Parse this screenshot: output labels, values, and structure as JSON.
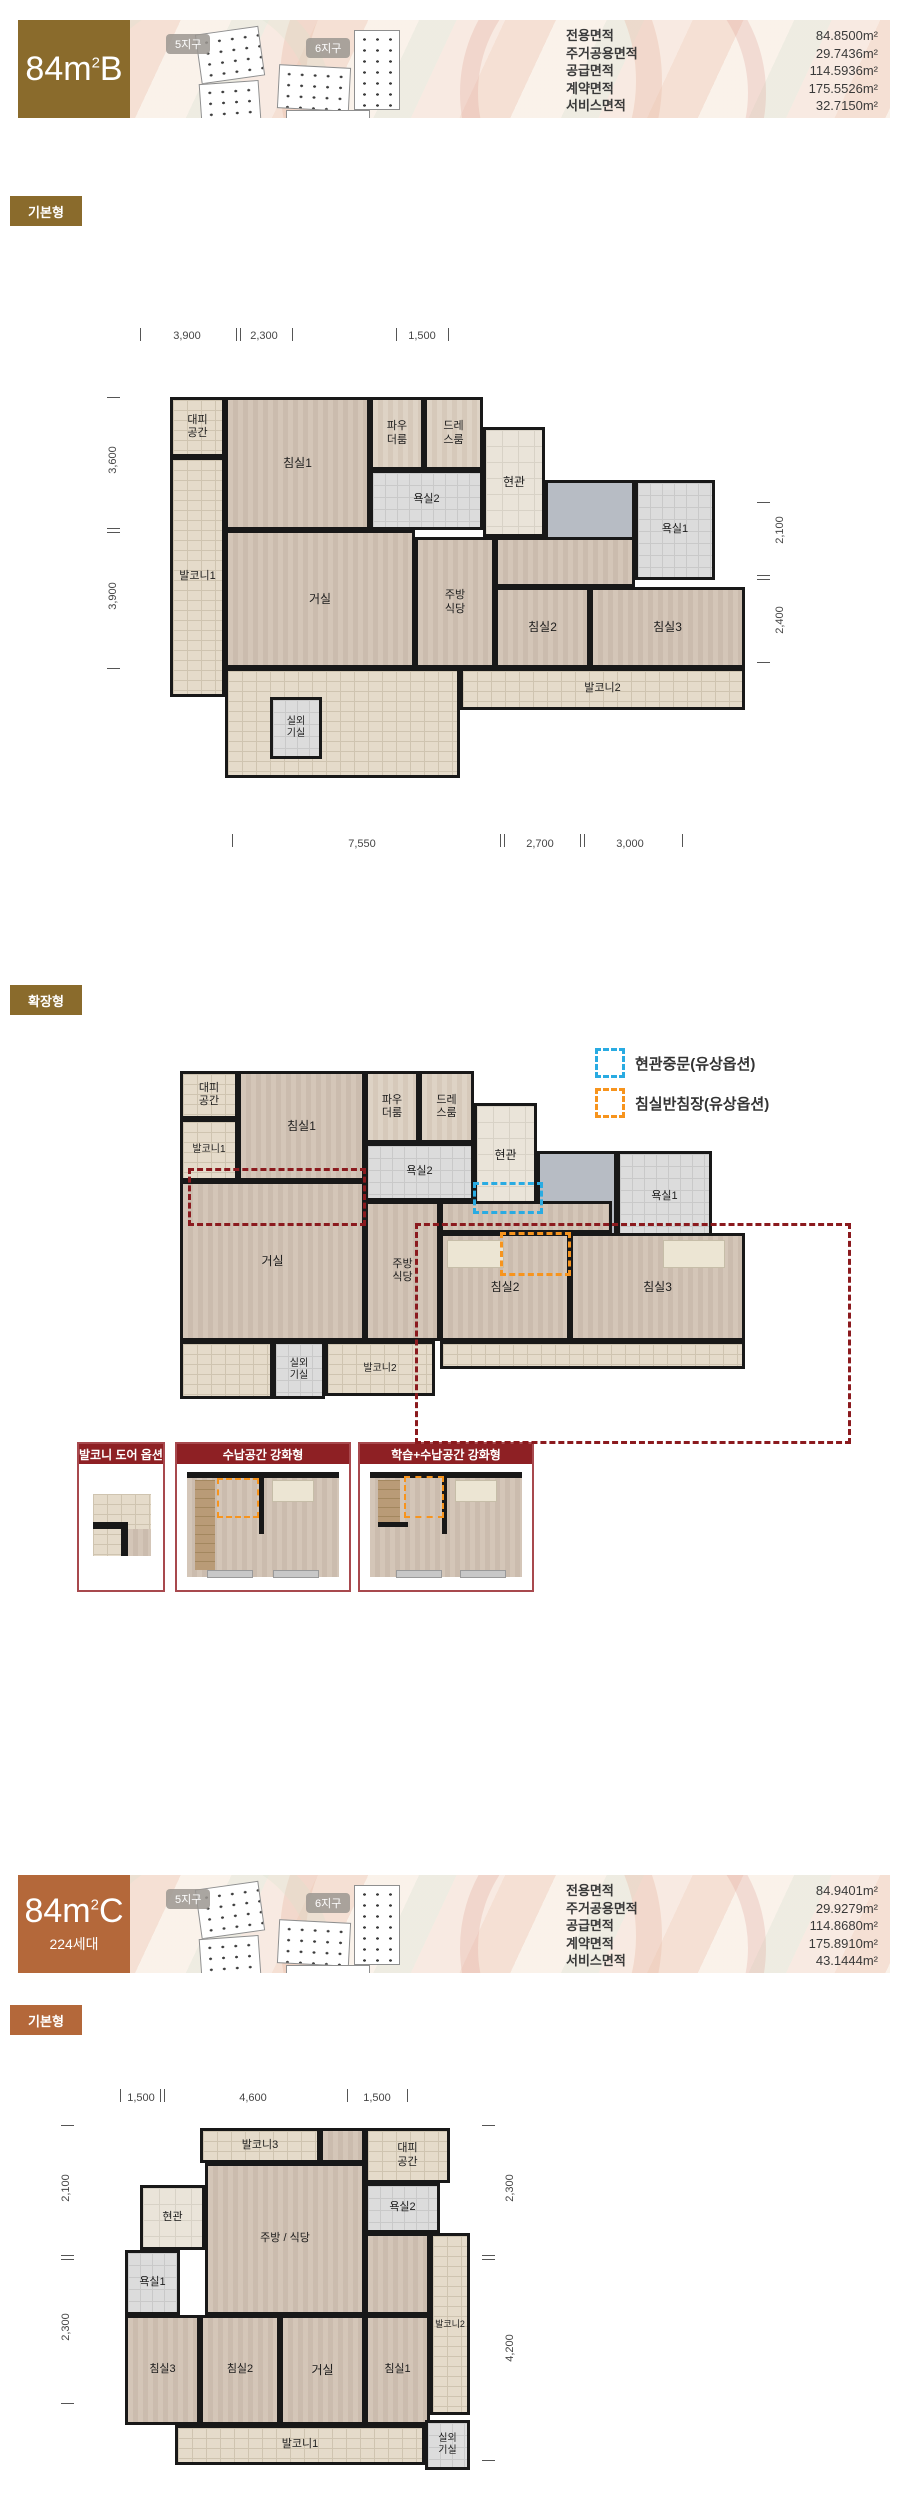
{
  "colors": {
    "brand_b": "#8a6b2c",
    "brand_c": "#b4683a",
    "option_header_red": "#8e2024",
    "dash_red": "#8b1a1e",
    "legend_blue": "#29abe2",
    "legend_orange": "#f7941d"
  },
  "section_b": {
    "title": {
      "num": "84",
      "unit": "m",
      "sup": "2",
      "variant": "B"
    },
    "site": {
      "district5": "5지구",
      "district6": "6지구"
    },
    "table": {
      "rows": [
        {
          "label": "전용면적",
          "value": "84.8500m²"
        },
        {
          "label": "주거공용면적",
          "value": "29.7436m²"
        },
        {
          "label": "공급면적",
          "value": "114.5936m²"
        },
        {
          "label": "계약면적",
          "value": "175.5526m²"
        },
        {
          "label": "서비스면적",
          "value": "32.7150m²"
        }
      ]
    },
    "badge_basic": "기본형",
    "badge_ext": "확장형",
    "plan_basic": {
      "dims": {
        "top": [
          "3,900",
          "2,300",
          "1,500"
        ],
        "left": [
          "3,600",
          "3,900"
        ],
        "right": [
          "2,100",
          "2,400"
        ],
        "bottom": [
          "7,550",
          "2,700",
          "3,000"
        ]
      },
      "rooms": {
        "daepi": "대피\n공간",
        "balcony1": "발코니1",
        "bedroom1": "침실1",
        "powder": "파우\n더룸",
        "dress": "드레\n스룸",
        "bath2": "욕실2",
        "entrance": "현관",
        "bath1": "욕실1",
        "living": "거실",
        "kitchen": "주방\n식당",
        "bedroom2": "침실2",
        "bedroom3": "침실3",
        "balcony2": "발코니2",
        "outdoor": "실외\n기실"
      }
    },
    "plan_ext": {
      "rooms": {
        "daepi": "대피\n공간",
        "balcony1": "발코니1",
        "bedroom1": "침실1",
        "powder": "파우\n더룸",
        "dress": "드레\n스룸",
        "bath2": "욕실2",
        "entrance": "현관",
        "bath1": "욕실1",
        "living": "거실",
        "kitchen": "주방\n식당",
        "bedroom2": "침실2",
        "bedroom3": "침실3",
        "balcony2": "발코니2",
        "outdoor": "실외\n기실"
      }
    },
    "legend": [
      {
        "label": "현관중문(유상옵션)",
        "color": "#29abe2"
      },
      {
        "label": "침실반침장(유상옵션)",
        "color": "#f7941d"
      }
    ],
    "options": [
      {
        "title": "발코니 도어 옵션"
      },
      {
        "title": "수납공간 강화형"
      },
      {
        "title": "학습+수납공간 강화형"
      }
    ]
  },
  "section_c": {
    "title": {
      "num": "84",
      "unit": "m",
      "sup": "2",
      "variant": "C",
      "households": "224세대"
    },
    "site": {
      "district5": "5지구",
      "district6": "6지구"
    },
    "table": {
      "rows": [
        {
          "label": "전용면적",
          "value": "84.9401m²"
        },
        {
          "label": "주거공용면적",
          "value": "29.9279m²"
        },
        {
          "label": "공급면적",
          "value": "114.8680m²"
        },
        {
          "label": "계약면적",
          "value": "175.8910m²"
        },
        {
          "label": "서비스면적",
          "value": "43.1444m²"
        }
      ]
    },
    "badge_basic": "기본형",
    "plan_basic": {
      "dims": {
        "top": [
          "1,500",
          "4,600",
          "1,500"
        ],
        "left": [
          "2,100",
          "2,300"
        ],
        "right": [
          "2,300",
          "4,200"
        ]
      },
      "rooms": {
        "balcony3": "발코니3",
        "daepi": "대피\n공간",
        "entrance": "현관",
        "bath1": "욕실1",
        "kitchen": "주방 / 식당",
        "bath2": "욕실2",
        "bedroom3": "침실3",
        "bedroom2": "침실2",
        "living": "거실",
        "bedroom1": "침실1",
        "balcony2": "발코니2",
        "balcony1": "발코니1",
        "outdoor": "실외\n기실"
      }
    }
  }
}
